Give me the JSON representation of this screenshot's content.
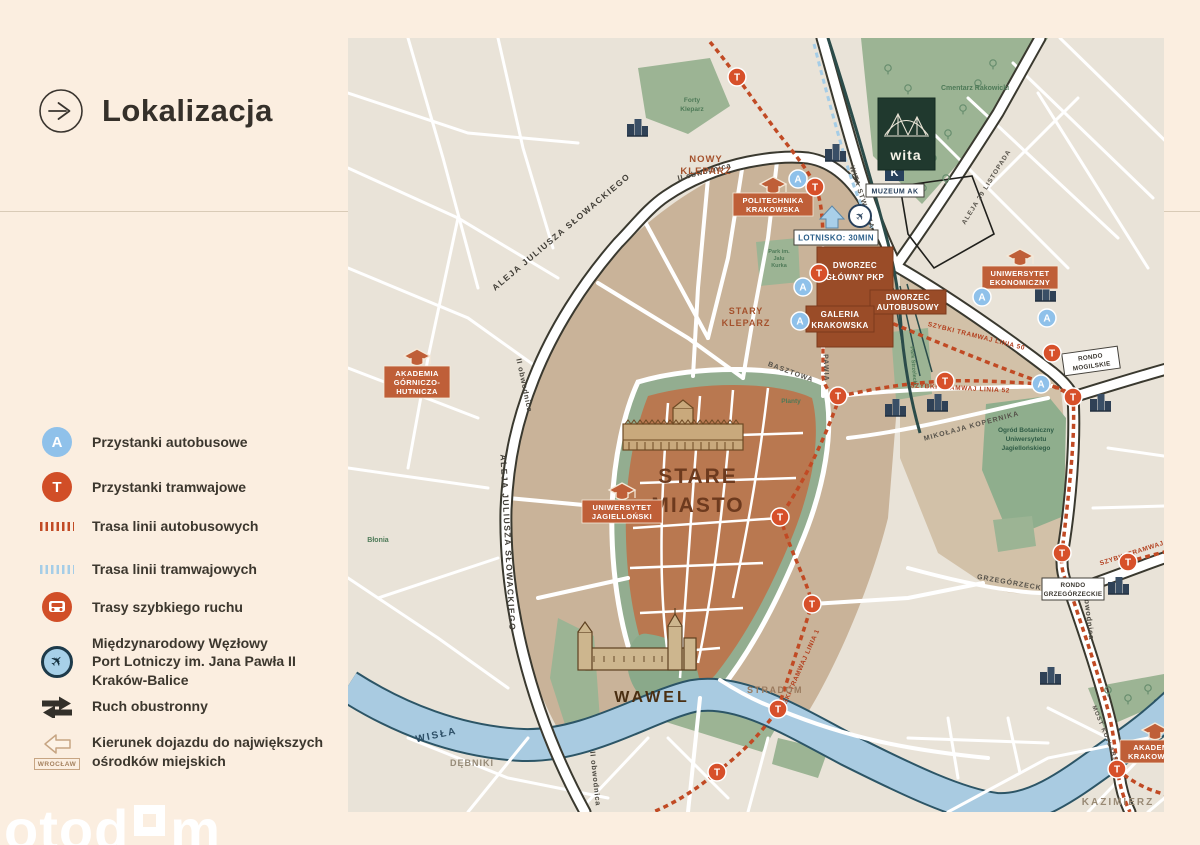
{
  "header": {
    "title": "Lokalizacja"
  },
  "legend": {
    "stop_bus": "A",
    "stop_tram": "T",
    "items": [
      {
        "label": "Przystanki autobusowe"
      },
      {
        "label": "Przystanki tramwajowe"
      },
      {
        "label": "Trasa linii autobusowych"
      },
      {
        "label": "Trasa linii tramwajowych"
      },
      {
        "label": "Trasy szybkiego ruchu"
      },
      {
        "label_lines": [
          "Międzynarodowy Węzłowy",
          "Port Lotniczy im. Jana Pawła II",
          "Kraków-Balice"
        ]
      },
      {
        "label": "Ruch obustronny"
      },
      {
        "label_lines": [
          "Kierunek dojazdu do największych",
          "ośrodków miejskich"
        ]
      }
    ],
    "wroclaw": "WROCŁAW"
  },
  "watermark": {
    "part1": "otod",
    "part2": "m"
  },
  "colors": {
    "background": "#fbeee0",
    "accent_orange": "#d14e27",
    "accent_blue": "#8fc1ea",
    "terracotta": "#b97850",
    "tan": "#c9b399",
    "park_green": "#9cb494",
    "river_blue": "#a9cbe1",
    "brand_green": "#20392e",
    "tram_dash": "#c14a24"
  },
  "map": {
    "brand": {
      "name": "wita"
    },
    "stop_letters": {
      "bus": "A",
      "tram": "T"
    },
    "areas": {
      "stare_miasto_1": "STARE",
      "stare_miasto_2": "MIASTO",
      "wawel": "WAWEL",
      "nowy_kleparz_1": "NOWY",
      "nowy_kleparz_2": "KLEPARZ",
      "stary_kleparz_1": "STARY",
      "stary_kleparz_2": "KLEPARZ",
      "kazimierz": "KAZIMIERZ",
      "debniki": "DĘBNIKI",
      "stradom": "STRADOM",
      "blonia": "Błonia"
    },
    "water": {
      "wisla": "WISŁA"
    },
    "parks": {
      "cmentarz": "Cmentarz Rakowicki",
      "forty_1": "Forty",
      "forty_2": "Kleparz",
      "jalu_1": "Park im.",
      "jalu_2": "Jalu",
      "jalu_3": "Kurka",
      "strzelecki": "Park Strzelecki",
      "planty": "Planty",
      "ogrod_1": "Ogród Botaniczny",
      "ogrod_2": "Uniwersytetu",
      "ogrod_3": "Jagiellońskiego"
    },
    "streets": {
      "slowackiego": "ALEJA JULIUSZA SŁOWACKIEGO",
      "obwodnica": "II obwodnica",
      "wita_stwosza": "WITA STWOSZA",
      "basztowa": "BASZTOWA",
      "pawia": "PAWIA",
      "kopernika": "MIKOŁAJA KOPERNIKA",
      "grzegorzecka": "GRZEGÓRZECKA",
      "most_kotlarski": "MOST KOTLARSKI",
      "listopada": "ALEJA 29 LISTOPADA"
    },
    "tram_labels": {
      "linia50": "SZYBKI TRAMWAJ LINIA 50",
      "linia52": "SZYBKI TRAMWAJ LINIA 52",
      "linia1": "SZYBKI TRAMWAJ LINIA 1"
    },
    "pois": {
      "politechnika_1": "POLITECHNIKA",
      "politechnika_2": "KRAKOWSKA",
      "ekonomiczny_1": "UNIWERSYTET",
      "ekonomiczny_2": "EKONOMICZNY",
      "agh_1": "AKADEMIA",
      "agh_2": "GÓRNICZO-",
      "agh_3": "HUTNICZA",
      "jagiellonski_1": "UNIWERSYTET",
      "jagiellonski_2": "JAGIELLOŃSKI",
      "akademia_1": "AKADEMIA",
      "akademia_2": "KRAKOWSKA"
    },
    "stations": {
      "pkp_1": "DWORZEC",
      "pkp_2": "GŁÓWNY PKP",
      "bus_1": "DWORZEC",
      "bus_2": "AUTOBUSOWY",
      "galeria_1": "GALERIA",
      "galeria_2": "KRAKOWSKA"
    },
    "info": {
      "lotnisko": "LOTNISKO: 30MIN",
      "muzeum": "MUZEUM AK",
      "muzeum_k": "K",
      "rondo_mogilskie_1": "RONDO",
      "rondo_mogilskie_2": "MOGILSKIE",
      "rondo_grzegorzeckie_1": "RONDO",
      "rondo_grzegorzeckie_2": "GRZEGÓRZECKIE"
    }
  }
}
